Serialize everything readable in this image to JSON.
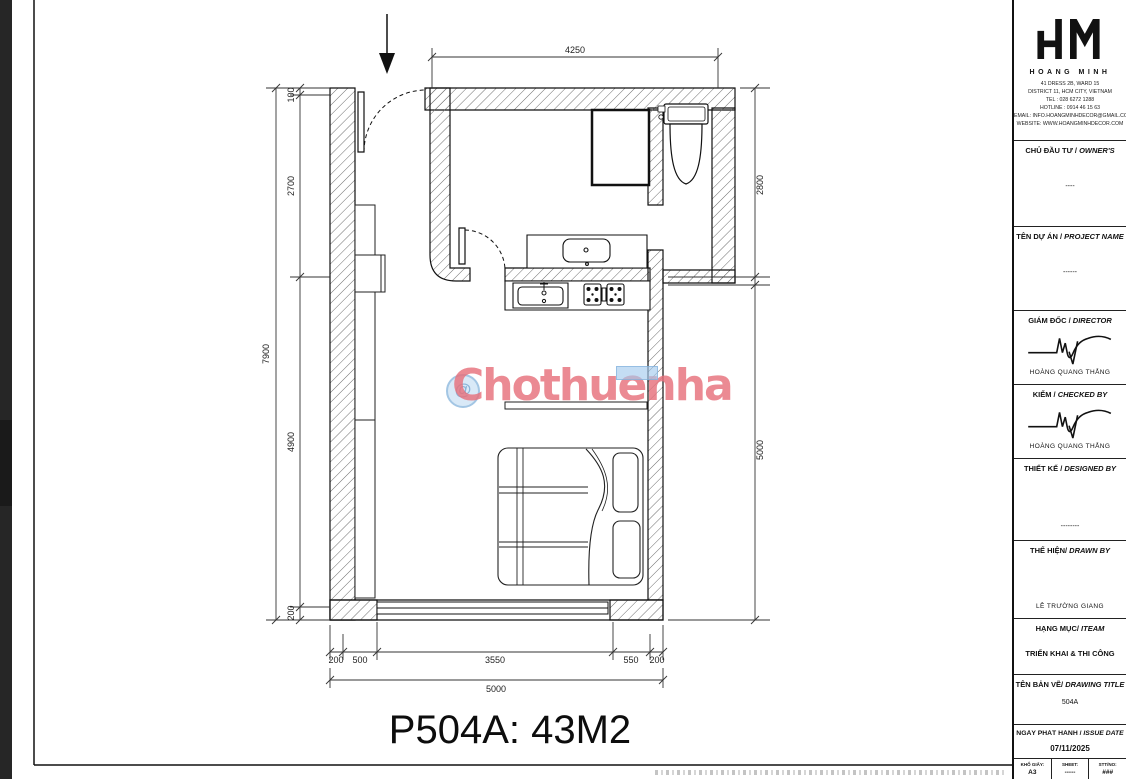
{
  "page": {
    "caption": "P504A: 43M2"
  },
  "watermark": {
    "text": "Chothuenha",
    "icon": "@",
    "color": "#e7707b",
    "icon_color": "#a3c6e4"
  },
  "plan": {
    "dims": {
      "top": "4250",
      "left_total": "7900",
      "left": [
        "100",
        "2700",
        "4900",
        "200"
      ],
      "right": [
        "2800",
        "5000"
      ],
      "bottom": [
        "200",
        "500",
        "3550",
        "550",
        "200"
      ],
      "bottom_total": "5000"
    }
  },
  "titleblock": {
    "company": {
      "name": "HOANG MINH",
      "address1": "41 DRESS 2B, WARD 15",
      "address2": "DISTRICT 11, HCM CITY, VIETNAM",
      "tel": "TEL : 028 6272 1288",
      "hotline": "HOTLINE : 0914 46 15 63",
      "email": "EMAIL: INFO.HOANGMINHDECOR@GMAIL.COM",
      "website": "WEBSITE: WWW.HOANGMINHDECOR.COM"
    },
    "owner": {
      "label_vi": "CHỦ ĐẦU TƯ /",
      "label_en": "OWNER'S",
      "value": "----"
    },
    "project": {
      "label_vi": "TÊN DỰ ÁN /",
      "label_en": "PROJECT NAME",
      "value": "------"
    },
    "director": {
      "label_vi": "GIÁM ĐỐC /",
      "label_en": "DIRECTOR",
      "value": "HOÀNG QUANG THẮNG"
    },
    "checked": {
      "label_vi": "KIỂM /",
      "label_en": "CHECKED BY",
      "value": "HOÀNG QUANG THẮNG"
    },
    "designed": {
      "label_vi": "THIẾT KẾ /",
      "label_en": "DESIGNED BY",
      "value": "--------"
    },
    "drawn": {
      "label_vi": "THỂ HIỆN/",
      "label_en": "DRAWN BY",
      "value": "LÊ TRƯỜNG GIANG"
    },
    "item": {
      "label_vi": "HẠNG MỤC/",
      "label_en": "ITEAM",
      "value": "TRIỂN KHAI & THI CÔNG"
    },
    "drawing_title": {
      "label_vi": "TÊN BẢN VẼ/",
      "label_en": "DRAWING TITLE",
      "value": "504A"
    },
    "issue_date": {
      "label_vi": "NGÀY PHÁT HÀNH /",
      "label_en": "ISSUE DATE",
      "value": "07/11/2025"
    },
    "paper": {
      "label": "KHỔ GIẤY:",
      "value": "A3"
    },
    "sheet": {
      "label": "SHEET:",
      "value": "-----"
    },
    "number": {
      "label": "STT/NO:",
      "value": "###"
    }
  }
}
